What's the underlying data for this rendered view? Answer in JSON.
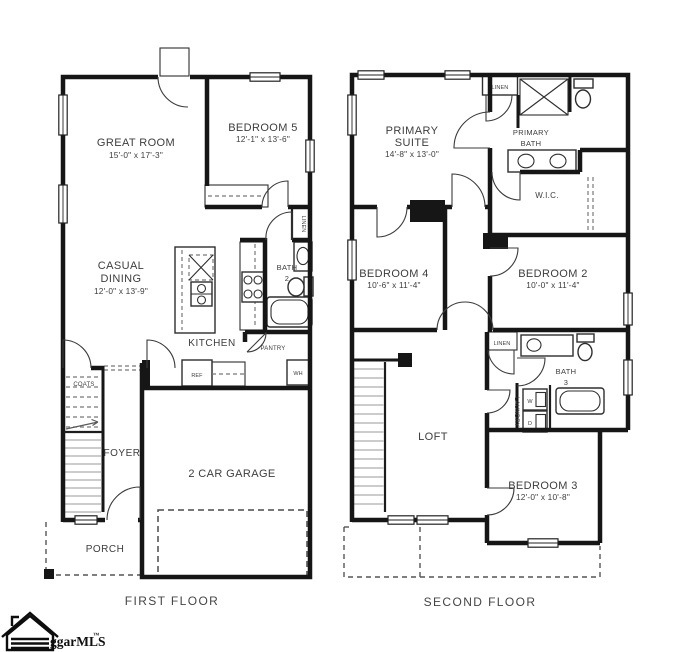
{
  "first_floor": {
    "label": "FIRST FLOOR",
    "great_room": {
      "name": "GREAT ROOM",
      "dims": "15'-0\" x 17'-3\""
    },
    "bedroom_5": {
      "name": "BEDROOM 5",
      "dims": "12'-1\" x 13'-6\""
    },
    "casual_dining": {
      "name_line1": "CASUAL",
      "name_line2": "DINING",
      "dims": "12'-0\" x 13'-9\""
    },
    "kitchen": {
      "name": "KITCHEN"
    },
    "bath_2": {
      "name_line1": "BATH",
      "name_line2": "2"
    },
    "foyer": {
      "name": "FOYER"
    },
    "garage": {
      "name": "2 CAR GARAGE"
    },
    "porch": {
      "name": "PORCH"
    },
    "coats": {
      "name": "COATS"
    },
    "pantry": {
      "name": "PANTRY"
    },
    "ref": {
      "name": "REF"
    },
    "water_heater": {
      "name": "WH"
    },
    "linen": {
      "name": "LINEN"
    }
  },
  "second_floor": {
    "label": "SECOND FLOOR",
    "primary_suite": {
      "name_line1": "PRIMARY",
      "name_line2": "SUITE",
      "dims": "14'-8\" x 13'-0\""
    },
    "primary_bath": {
      "name_line1": "PRIMARY",
      "name_line2": "BATH"
    },
    "wic": {
      "name": "W.I.C."
    },
    "bedroom_4": {
      "name": "BEDROOM 4",
      "dims": "10'-6\" x 11'-4\""
    },
    "bedroom_2": {
      "name": "BEDROOM 2",
      "dims": "10'-0\" x 11'-4\""
    },
    "loft": {
      "name": "LOFT"
    },
    "bath_3": {
      "name_line1": "BATH",
      "name_line2": "3"
    },
    "laundry": {
      "name": "LAUNDRY",
      "washer": "W",
      "dryer": "D"
    },
    "bedroom_3": {
      "name": "BEDROOM 3",
      "dims": "12'-0\" x 10'-8\""
    },
    "linen_upper": {
      "name": "LINEN"
    },
    "linen_hall": {
      "name": "LINEN"
    }
  },
  "logo": {
    "brand": "ggarMLS",
    "trademark": "™"
  },
  "colors": {
    "wall_ink": "#161616",
    "label_ink": "#3d3d3d",
    "background": "#ffffff"
  }
}
